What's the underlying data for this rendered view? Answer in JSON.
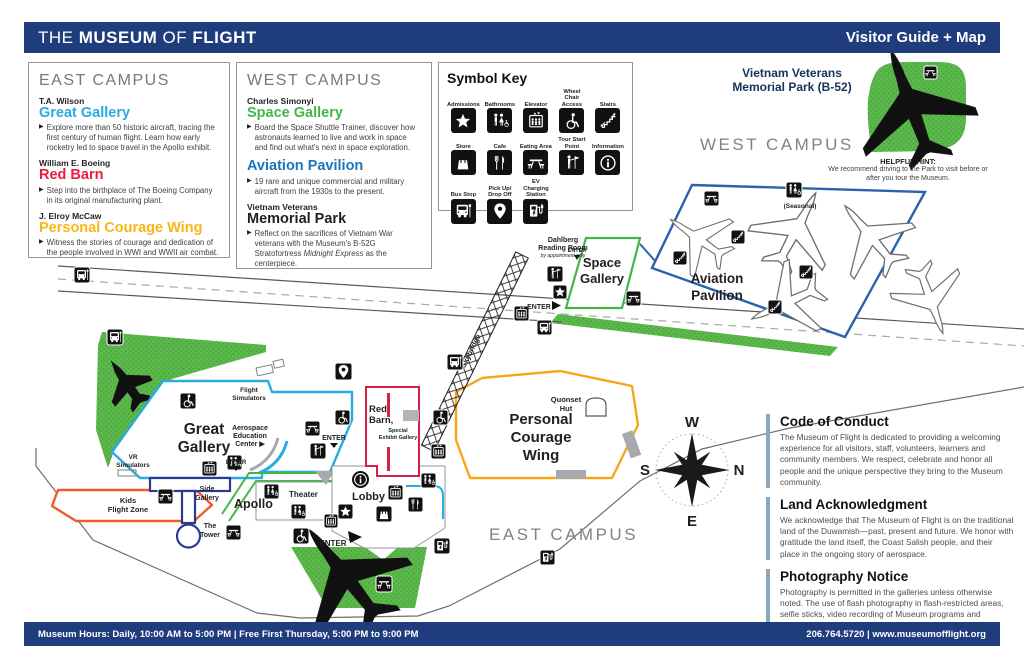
{
  "ui": {
    "bullet": "▶"
  },
  "header": {
    "brand": [
      "THE",
      "MUSEUM",
      "OF",
      "FLIGHT"
    ],
    "right_title": "Visitor Guide + Map"
  },
  "footer": {
    "hours": "Museum Hours: Daily, 10:00 AM to 5:00 PM | Free First Thursday, 5:00 PM to 9:00 PM",
    "contact": "206.764.5720 | www.museumofflight.org"
  },
  "east_campus_panel": {
    "title": "EAST CAMPUS",
    "items": [
      {
        "sponsor": "T.A. Wilson",
        "name": "Great Gallery",
        "color": "#29abe2",
        "desc": "Explore more than 50 historic aircraft, tracing the first century of human flight. Learn how early rocketry led to space travel in the Apollo exhibit."
      },
      {
        "sponsor": "William E. Boeing",
        "name": "Red Barn",
        "color": "#ed1a3d",
        "desc": "Step into the birthplace of The Boeing Company in its original manufacturing plant."
      },
      {
        "sponsor": "J. Elroy McCaw",
        "name": "Personal Courage Wing",
        "color": "#fbb615",
        "desc": "Witness the stories of courage and dedication of the people involved in WWI and WWII air combat."
      }
    ]
  },
  "west_campus_panel": {
    "title": "WEST CAMPUS",
    "items": [
      {
        "sponsor": "Charles Simonyi",
        "name": "Space Gallery",
        "color": "#44b649",
        "desc": "Board the Space Shuttle Trainer, discover how astronauts learned to live and work in space and find out what's next in space exploration."
      },
      {
        "sponsor": "",
        "name": "Aviation Pavilion",
        "color": "#1b75bc",
        "desc": "19 rare and unique commercial and military aircraft from the 1930s to the present."
      },
      {
        "sponsor": "Vietnam Veterans",
        "name": "Memorial Park",
        "color": "#231f20",
        "desc_prefix": "Reflect on the sacrifices of Vietnam War veterans with the Museum's B-52G Stratofortress ",
        "desc_italic": "Midnight Express",
        "desc_suffix": " as the centerpiece."
      }
    ]
  },
  "symbol_key": {
    "title": "Symbol Key",
    "items": [
      {
        "label": "Admissions",
        "icon": "admissions"
      },
      {
        "label": "Bathrooms",
        "icon": "bathrooms"
      },
      {
        "label": "Elevator",
        "icon": "elevator"
      },
      {
        "label": "Wheel Chair Access",
        "icon": "wheelchair"
      },
      {
        "label": "Stairs",
        "icon": "stairs"
      },
      {
        "label": "Store",
        "icon": "store"
      },
      {
        "label": "Cafe",
        "icon": "cafe"
      },
      {
        "label": "Eating Area",
        "icon": "eating-area"
      },
      {
        "label": "Tour Start Point",
        "icon": "tour-start"
      },
      {
        "label": "Information",
        "icon": "information"
      },
      {
        "label": "Bus Stop",
        "icon": "bus-stop"
      },
      {
        "label": "Pick Up/ Drop Off",
        "icon": "pick-up-drop-off"
      },
      {
        "label": "EV Charging Station",
        "icon": "ev-charging"
      }
    ]
  },
  "memorial_park": {
    "title_line1": "Vietnam Veterans",
    "title_line2": "Memorial Park (B-52)",
    "hint_title": "HELPFUL HINT:",
    "hint_body": "We recommend driving to the Park to visit before or after you tour the Museum."
  },
  "map": {
    "west_campus": "WEST CAMPUS",
    "east_campus": "EAST CAMPUS",
    "enter": "ENTER",
    "skybridge": "Skybridge",
    "seasonal": "(Seasonal)",
    "labels": {
      "great_1": "Great",
      "great_2": "Gallery",
      "flight_sim_1": "Flight",
      "flight_sim_2": "Simulators",
      "aero_1": "Aerospace",
      "aero_2": "Education",
      "aero_3": "Center ▶",
      "vr_1": "VR",
      "vr_2": "Simulators",
      "kids_1": "Kids",
      "kids_2": "Flight Zone",
      "side_1": "Side",
      "side_2": "Gallery",
      "apollo": "Apollo",
      "theater": "Theater",
      "tower_1": "The",
      "tower_2": "Tower",
      "lobby": "Lobby",
      "red_1": "Red",
      "red_2": "Barn,",
      "special_1": "Special",
      "special_2": "Exhibit Gallery",
      "quonset_1": "Quonset",
      "quonset_2": "Hut",
      "pcw_1": "Personal",
      "pcw_2": "Courage",
      "pcw_3": "Wing",
      "space_1": "Space",
      "space_2": "Gallery",
      "aviation_1": "Aviation",
      "aviation_2": "Pavilion",
      "dahlberg_1": "Dahlberg",
      "dahlberg_2": "Reading Room",
      "dahlberg_3": "by appointment only"
    },
    "compass": {
      "n": "N",
      "e": "E",
      "s": "S",
      "w": "W"
    }
  },
  "info_sections": [
    {
      "title": "Code of Conduct",
      "body": "The Museum of Flight is dedicated to providing a welcoming experience for all visitors, staff, volunteers, learners and community members. We respect, celebrate and honor all people and the unique perspective they bring to the Museum community."
    },
    {
      "title": "Land Acknowledgment",
      "body": "We acknowledge that The Museum of Flight is on the traditional land of the Duwamish—past, present and future. We honor with gratitude the land itself, the Coast Salish people, and their place in the ongoing story of aerospace."
    },
    {
      "title": "Photography Notice",
      "body": "Photography is permitted in the galleries unless otherwise noted. The use of flash photography in flash-restricted areas, selfie sticks, video recording of Museum programs and commercial photography is prohibited."
    }
  ],
  "colors": {
    "header_bg": "#1f3d7c",
    "map_green": "#5bb84a",
    "great_gallery": "#29abe2",
    "red_barn": "#d91e49",
    "personal_courage_wing": "#f9a51a",
    "space_gallery": "#44b649",
    "aviation_pavilion": "#2a62ad",
    "kids_flight_zone": "#f15a29",
    "tower_blue": "#2b3990"
  }
}
